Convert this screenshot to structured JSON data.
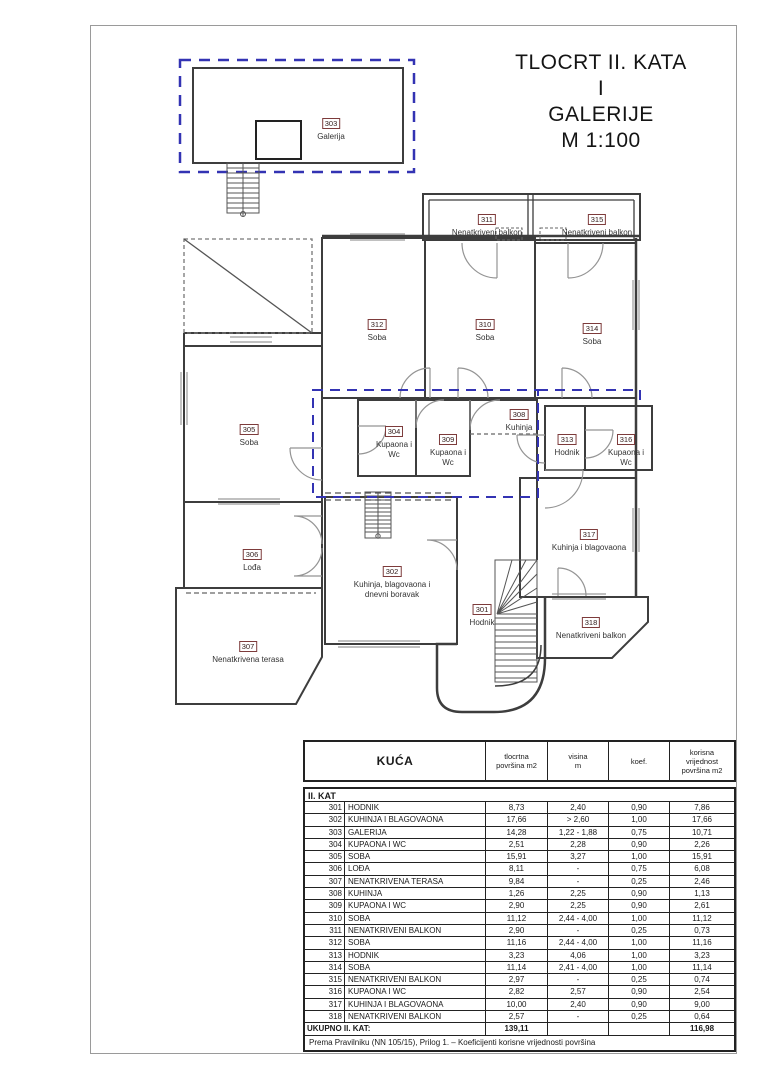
{
  "title": {
    "lines": [
      "TLOCRT II. KATA",
      "I",
      "GALERIJE",
      "M 1:100"
    ]
  },
  "colors": {
    "blue_dashed_outline": "#3333b3",
    "wall_line": "#3d3d3d",
    "label_box_border": "#7d3b3b",
    "window_line": "#9b9b9b"
  },
  "plan": {
    "labels": [
      {
        "num": "303",
        "name": "Galerija",
        "x": 331,
        "y": 113
      },
      {
        "num": "311",
        "name": "Nenatkriveni balkon",
        "x": 487,
        "y": 209
      },
      {
        "num": "315",
        "name": "Nenatkriveni balkon",
        "x": 597,
        "y": 209
      },
      {
        "num": "312",
        "name": "Soba",
        "x": 377,
        "y": 314
      },
      {
        "num": "310",
        "name": "Soba",
        "x": 485,
        "y": 314
      },
      {
        "num": "314",
        "name": "Soba",
        "x": 592,
        "y": 318
      },
      {
        "num": "305",
        "name": "Soba",
        "x": 249,
        "y": 419
      },
      {
        "num": "304",
        "name": "Kupaona i\nWc",
        "x": 394,
        "y": 421
      },
      {
        "num": "309",
        "name": "Kupaona i\nWc",
        "x": 448,
        "y": 429
      },
      {
        "num": "308",
        "name": "Kuhinja",
        "x": 519,
        "y": 404
      },
      {
        "num": "313",
        "name": "Hodnik",
        "x": 567,
        "y": 429
      },
      {
        "num": "316",
        "name": "Kupaona i\nWc",
        "x": 626,
        "y": 429
      },
      {
        "num": "306",
        "name": "Lođa",
        "x": 252,
        "y": 544
      },
      {
        "num": "317",
        "name": "Kuhinja i blagovaona",
        "x": 589,
        "y": 524
      },
      {
        "num": "302",
        "name": "Kuhinja, blagovaona i\ndnevni boravak",
        "x": 392,
        "y": 561
      },
      {
        "num": "301",
        "name": "Hodnik",
        "x": 482,
        "y": 599
      },
      {
        "num": "318",
        "name": "Nenatkriveni balkon",
        "x": 591,
        "y": 612
      },
      {
        "num": "307",
        "name": "Nenatkrivena terasa",
        "x": 248,
        "y": 636
      }
    ]
  },
  "table": {
    "headers": {
      "kuca": "KUĆA",
      "tlocrtna": "tlocrtna\npovršina m2",
      "visina": "visina\nm",
      "koef": "koef.",
      "korisna": "korisna\nvrijednost\npovršina m2"
    },
    "section": "II. KAT",
    "rows": [
      {
        "num": "301",
        "name": "HODNIK",
        "area": "8,73",
        "visina": "2,40",
        "koef": "0,90",
        "value": "7,86"
      },
      {
        "num": "302",
        "name": "KUHINJA I BLAGOVAONA",
        "area": "17,66",
        "visina": "> 2,60",
        "koef": "1,00",
        "value": "17,66"
      },
      {
        "num": "303",
        "name": "GALERIJA",
        "area": "14,28",
        "visina": "1,22 - 1,88",
        "koef": "0,75",
        "value": "10,71"
      },
      {
        "num": "304",
        "name": "KUPAONA I WC",
        "area": "2,51",
        "visina": "2,28",
        "koef": "0,90",
        "value": "2,26"
      },
      {
        "num": "305",
        "name": "SOBA",
        "area": "15,91",
        "visina": "3,27",
        "koef": "1,00",
        "value": "15,91"
      },
      {
        "num": "306",
        "name": "LOĐA",
        "area": "8,11",
        "visina": "-",
        "koef": "0,75",
        "value": "6,08"
      },
      {
        "num": "307",
        "name": "NENATKRIVENA TERASA",
        "area": "9,84",
        "visina": "-",
        "koef": "0,25",
        "value": "2,46"
      },
      {
        "num": "308",
        "name": "KUHINJA",
        "area": "1,26",
        "visina": "2,25",
        "koef": "0,90",
        "value": "1,13"
      },
      {
        "num": "309",
        "name": "KUPAONA I WC",
        "area": "2,90",
        "visina": "2,25",
        "koef": "0,90",
        "value": "2,61"
      },
      {
        "num": "310",
        "name": "SOBA",
        "area": "11,12",
        "visina": "2,44 - 4,00",
        "koef": "1,00",
        "value": "11,12"
      },
      {
        "num": "311",
        "name": "NENATKRIVENI BALKON",
        "area": "2,90",
        "visina": "-",
        "koef": "0,25",
        "value": "0,73"
      },
      {
        "num": "312",
        "name": "SOBA",
        "area": "11,16",
        "visina": "2,44 - 4,00",
        "koef": "1,00",
        "value": "11,16"
      },
      {
        "num": "313",
        "name": "HODNIK",
        "area": "3,23",
        "visina": "4,06",
        "koef": "1,00",
        "value": "3,23"
      },
      {
        "num": "314",
        "name": "SOBA",
        "area": "11,14",
        "visina": "2,41 - 4,00",
        "koef": "1,00",
        "value": "11,14"
      },
      {
        "num": "315",
        "name": "NENATKRIVENI BALKON",
        "area": "2,97",
        "visina": "-",
        "koef": "0,25",
        "value": "0,74"
      },
      {
        "num": "316",
        "name": "KUPAONA I WC",
        "area": "2,82",
        "visina": "2,57",
        "koef": "0,90",
        "value": "2,54"
      },
      {
        "num": "317",
        "name": "KUHINJA I BLAGOVAONA",
        "area": "10,00",
        "visina": "2,40",
        "koef": "0,90",
        "value": "9,00"
      },
      {
        "num": "318",
        "name": "NENATKRIVENI BALKON",
        "area": "2,57",
        "visina": "-",
        "koef": "0,25",
        "value": "0,64"
      }
    ],
    "total": {
      "label": "UKUPNO II. KAT:",
      "area": "139,11",
      "value": "116,98"
    },
    "footnote": "Prema Pravilniku (NN 105/15), Prilog 1. – Koeficijenti korisne vrijednosti površina"
  }
}
